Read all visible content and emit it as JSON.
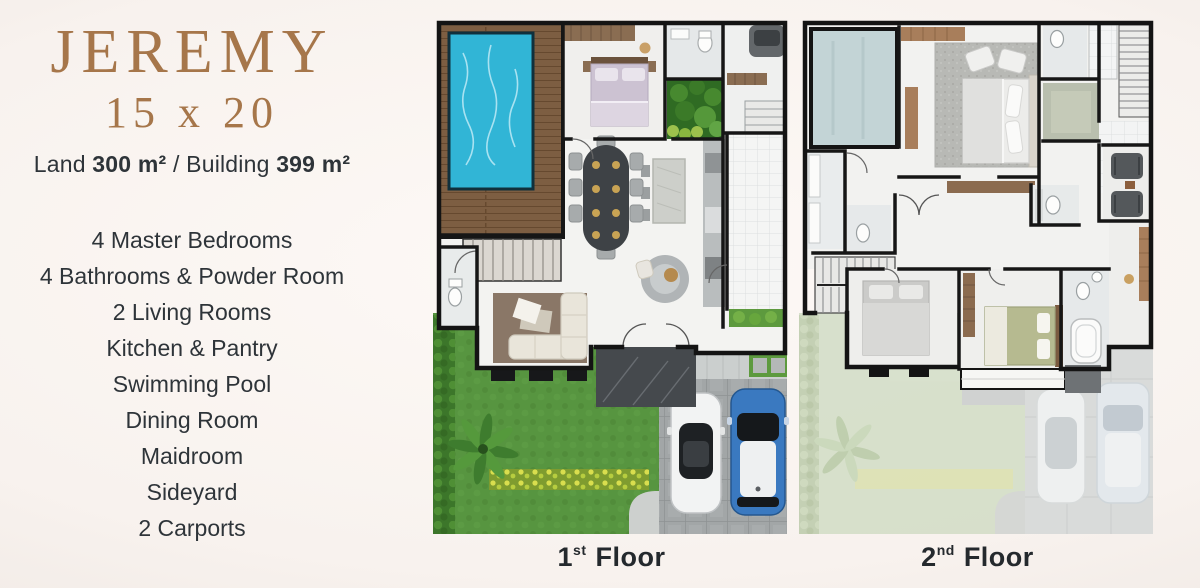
{
  "brand": {
    "title": "JEREMY",
    "size": "15 x 20",
    "area": {
      "land_label": "Land",
      "land_value": "300 m²",
      "separator": "/",
      "building_label": "Building",
      "building_value": "399 m²"
    }
  },
  "features": [
    "4 Master Bedrooms",
    "4 Bathrooms & Powder Room",
    "2 Living Rooms",
    "Kitchen & Pantry",
    "Swimming Pool",
    "Dining Room",
    "Maidroom",
    "Sideyard",
    "2 Carports"
  ],
  "floors": {
    "first": {
      "num": "1",
      "ordinal": "st",
      "word": "Floor"
    },
    "second": {
      "num": "2",
      "ordinal": "nd",
      "word": "Floor"
    }
  },
  "palette": {
    "title_bronze": "#A6764A",
    "text_dark": "#2E3439",
    "pool_water": "#31B5D6",
    "deck_wood": "#7D5E42",
    "grass": "#579540",
    "ghost_grass": "#D6DFCA",
    "carport_gray": "#A2A6A7",
    "car_blue": "#3A79C0",
    "patio_stone": "#45494D"
  }
}
